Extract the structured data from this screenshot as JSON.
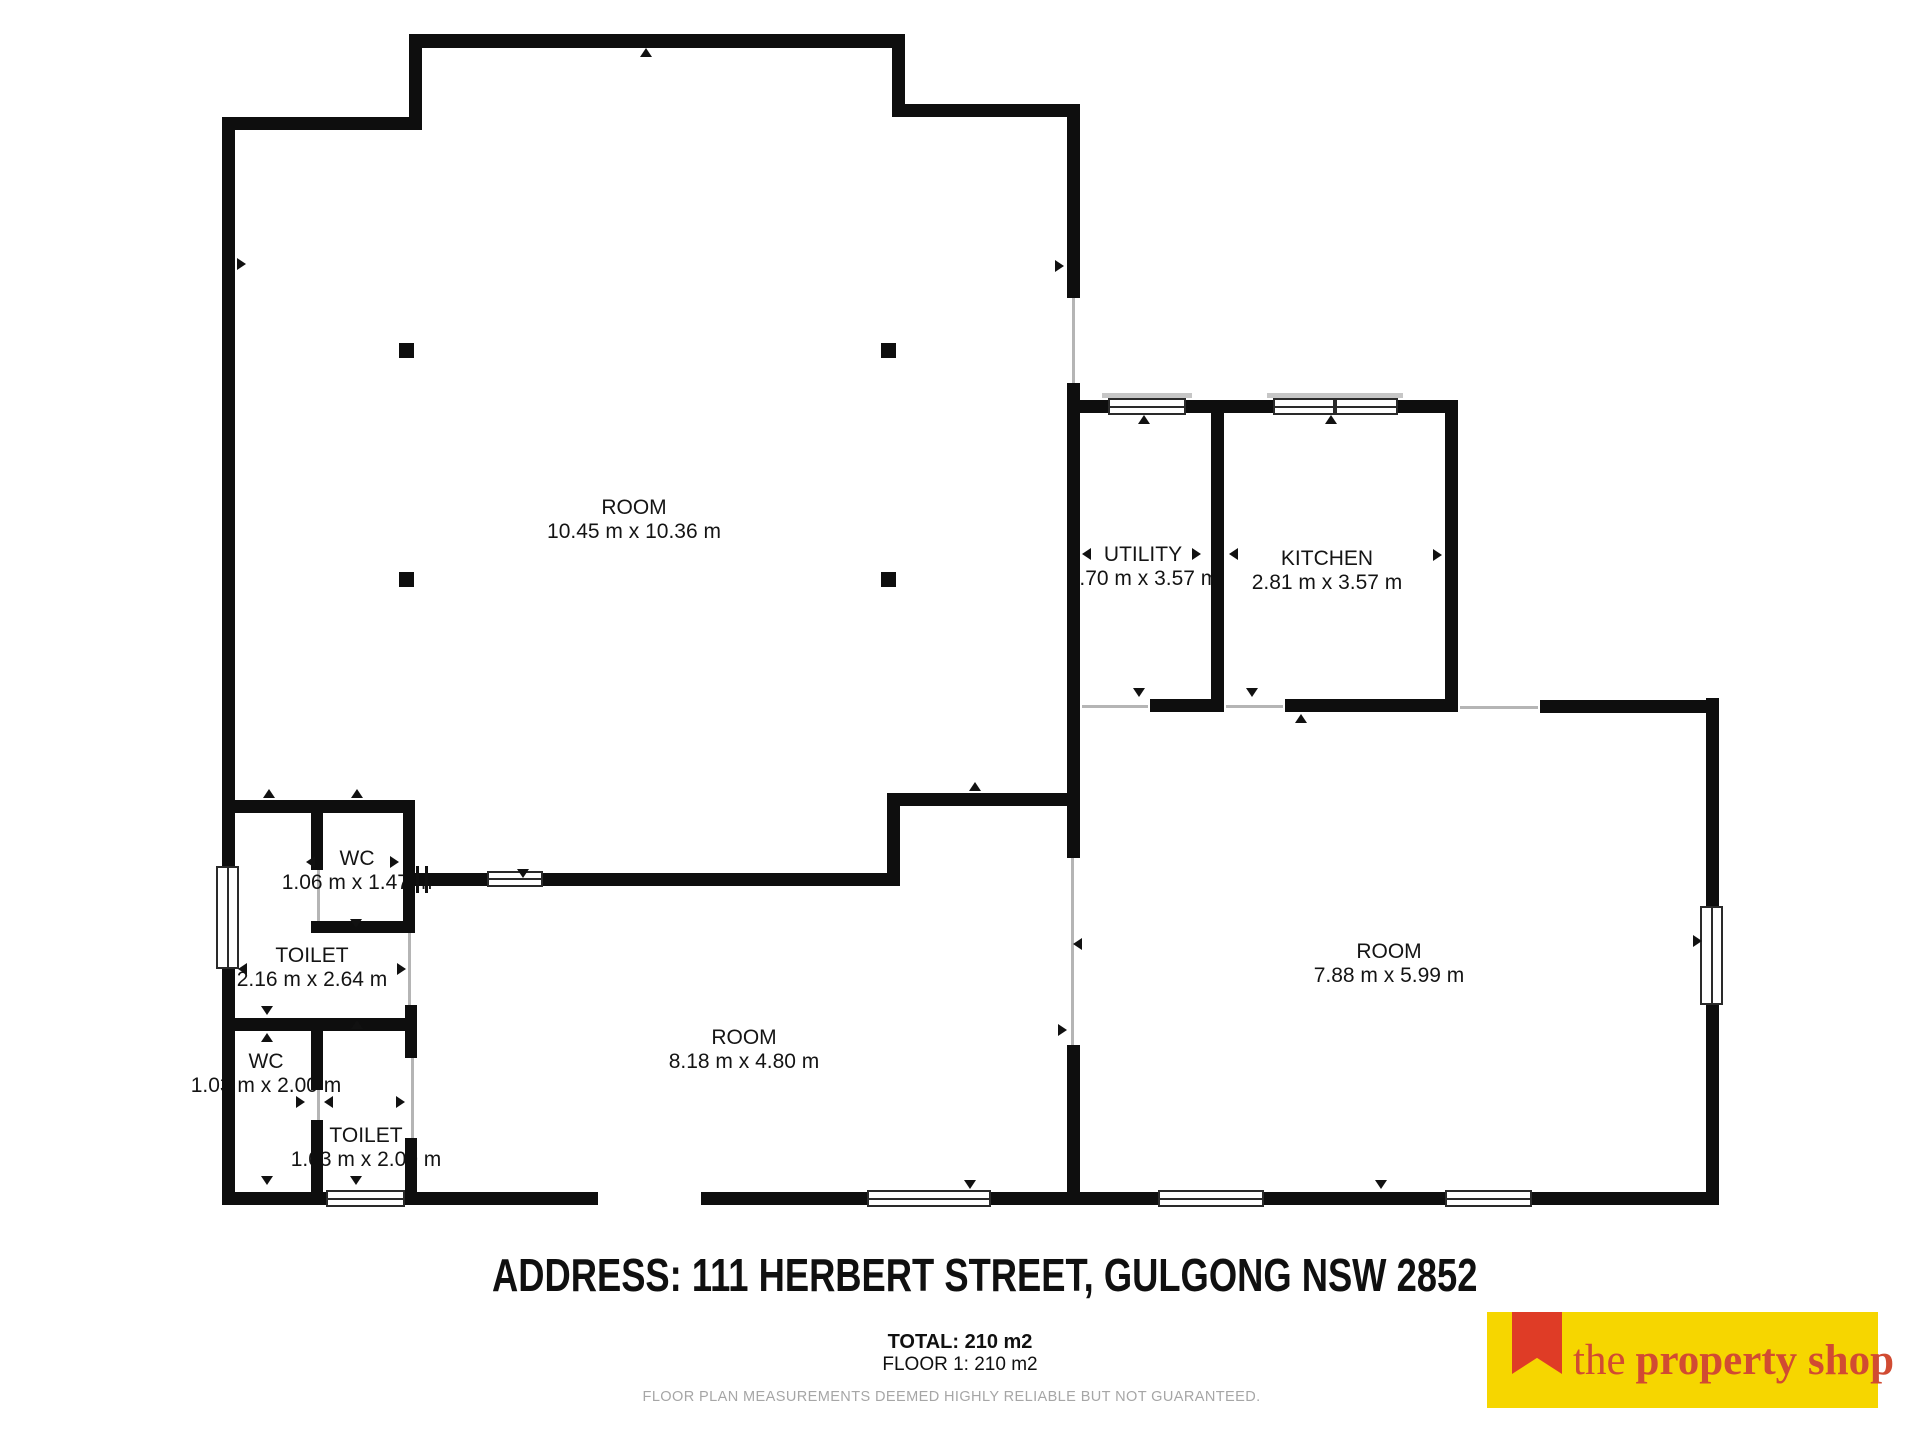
{
  "plan": {
    "rooms": [
      {
        "id": "main-room",
        "name": "ROOM",
        "dims": "10.45 m x 10.36 m"
      },
      {
        "id": "utility",
        "name": "UTILITY",
        "dims": "1.70 m x 3.57 m"
      },
      {
        "id": "kitchen",
        "name": "KITCHEN",
        "dims": "2.81 m x 3.57 m"
      },
      {
        "id": "wc-upper",
        "name": "WC",
        "dims": "1.06 m x 1.47 m"
      },
      {
        "id": "toilet-upper",
        "name": "TOILET",
        "dims": "2.16 m x 2.64 m"
      },
      {
        "id": "wc-lower",
        "name": "WC",
        "dims": "1.03 m x 2.00 m"
      },
      {
        "id": "toilet-lower",
        "name": "TOILET",
        "dims": "1.03 m x 2.00 m"
      },
      {
        "id": "room-bottom",
        "name": "ROOM",
        "dims": "8.18 m x 4.80 m"
      },
      {
        "id": "room-right",
        "name": "ROOM",
        "dims": "7.88 m x 5.99 m"
      }
    ]
  },
  "footer": {
    "address": "ADDRESS: 111 HERBERT STREET, GULGONG NSW 2852",
    "total": "TOTAL: 210 m2",
    "floor": "FLOOR 1: 210 m2",
    "disclaimer": "FLOOR PLAN MEASUREMENTS DEEMED HIGHLY RELIABLE BUT NOT GUARANTEED."
  },
  "logo": {
    "the": "the",
    "name": "property shop",
    "yellow": "#F6D600",
    "ribbon_red": "#DF3C26",
    "text_red": "#D14B32"
  },
  "colors": {
    "wall": "#0E0E0E",
    "disclaimer_gray": "#A6A6A6"
  }
}
